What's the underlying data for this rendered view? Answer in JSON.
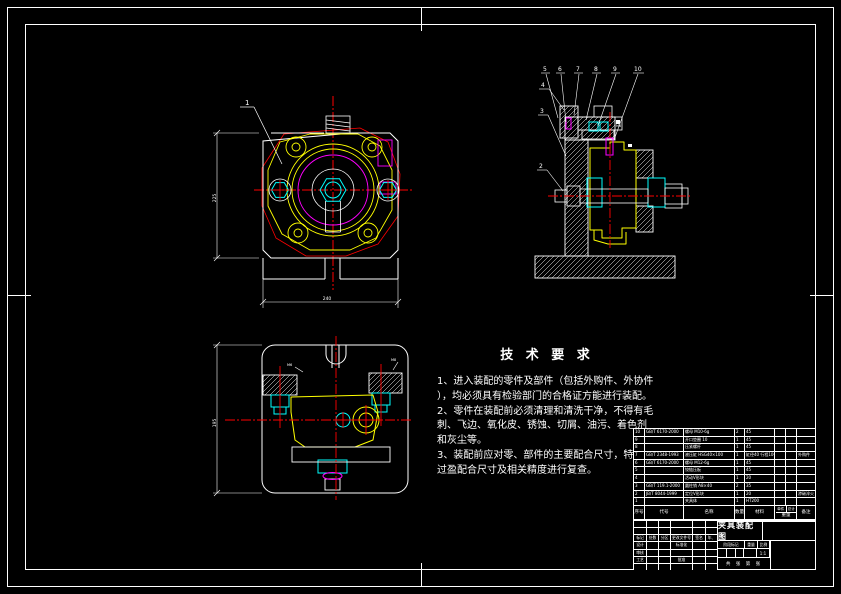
{
  "colors": {
    "line": "#ffffff",
    "part": "#ffff00",
    "center": "#ff0000",
    "fastener": "#00ffff",
    "pin": "#ff00ff",
    "bg": "#000000"
  },
  "annotations": {
    "front_balloon": "1",
    "side_balloons_top": [
      "5",
      "6",
      "7",
      "8",
      "9",
      "10"
    ],
    "side_balloons_left": [
      "4",
      "3",
      "2"
    ],
    "front_dim_width": "240",
    "front_dim_height": "225",
    "bottom_dim_height": "195",
    "bottom_dim_left_label": "M6",
    "bottom_dim_right_label": "M8",
    "side_dim_label": "M6"
  },
  "tech_req": {
    "title": "技 术 要 求",
    "lines": [
      "1、进入装配的零件及部件（包括外购件、外协件",
      "），均必须具有检验部门的合格证方能进行装配。",
      "2、零件在装配前必须清理和清洗干净，不得有毛",
      "刺、飞边、氧化皮、锈蚀、切屑、油污、着色剂",
      "和灰尘等。",
      "3、装配前应对零、部件的主要配合尺寸，特别是",
      "过盈配合尺寸及相关精度进行复查。"
    ]
  },
  "bom": {
    "headers": {
      "num": "序号",
      "code": "代号",
      "name": "名称",
      "qty": "数量",
      "material": "材料",
      "unit": "单件",
      "total": "总计",
      "weight": "重量",
      "note": "备注"
    },
    "rows": [
      {
        "num": "10",
        "code": "GB/T 6170-2000",
        "name": "螺母 M10-6g",
        "qty": "2",
        "material": "45",
        "unit": "",
        "total": "",
        "note": ""
      },
      {
        "num": "9",
        "code": "",
        "name": "开口垫圈 10",
        "qty": "1",
        "material": "45",
        "unit": "",
        "total": "",
        "note": ""
      },
      {
        "num": "8",
        "code": "",
        "name": "压紧螺杆",
        "qty": "1",
        "material": "45",
        "unit": "",
        "total": "",
        "note": ""
      },
      {
        "num": "7",
        "code": "GB/T 2348-1993",
        "name": "液压缸 HSG40×100",
        "qty": "1",
        "material": "缸径40 行程100",
        "unit": "",
        "total": "",
        "note": "外购件"
      },
      {
        "num": "6",
        "code": "GB/T 6170-2000",
        "name": "螺母 M12-6g",
        "qty": "1",
        "material": "45",
        "unit": "",
        "total": "",
        "note": ""
      },
      {
        "num": "5",
        "code": "",
        "name": "铰链压板",
        "qty": "1",
        "material": "45",
        "unit": "",
        "total": "",
        "note": ""
      },
      {
        "num": "4",
        "code": "",
        "name": "活动V形块",
        "qty": "1",
        "material": "20",
        "unit": "",
        "total": "",
        "note": ""
      },
      {
        "num": "3",
        "code": "GB/T 119.1-2000",
        "name": "圆柱销 A8×40",
        "qty": "2",
        "material": "35",
        "unit": "",
        "total": "",
        "note": ""
      },
      {
        "num": "2",
        "code": "JB/T 8044-1999",
        "name": "定位V形块",
        "qty": "1",
        "material": "20",
        "unit": "",
        "total": "",
        "note": "渗碳淬火"
      },
      {
        "num": "1",
        "code": "",
        "name": "夹具体",
        "qty": "1",
        "material": "HT200",
        "unit": "",
        "total": "",
        "note": ""
      }
    ]
  },
  "title_block": {
    "title": "夹具装配图",
    "rev": [
      "标记",
      "处数",
      "分区",
      "更改文件号",
      "签名",
      "年、月、日"
    ],
    "roles": {
      "design": "设计",
      "check": "审核",
      "process": "工艺",
      "standard": "标准化",
      "approve": "批准"
    },
    "stage_label": "阶段标记",
    "weight_label": "重量",
    "scale_label": "比例",
    "scale_value": "1:1",
    "sheets": "共 张 第 张"
  }
}
